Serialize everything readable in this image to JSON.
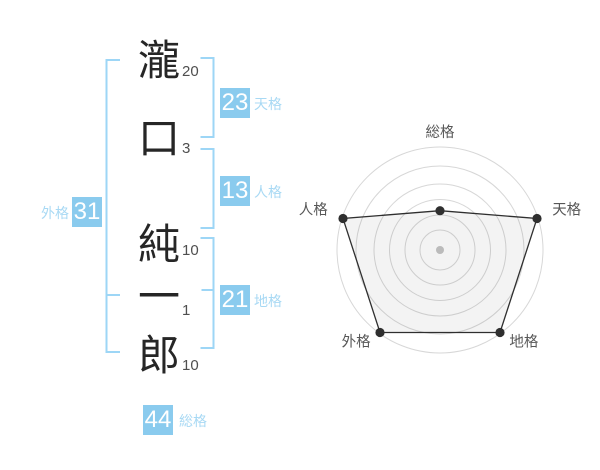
{
  "name_breakdown": {
    "characters": [
      {
        "char": "瀧",
        "strokes": "20"
      },
      {
        "char": "口",
        "strokes": "3"
      },
      {
        "char": "純",
        "strokes": "10"
      },
      {
        "char": "一",
        "strokes": "1"
      },
      {
        "char": "郎",
        "strokes": "10"
      }
    ]
  },
  "kaku": [
    {
      "id": "tenkaku",
      "label": "天格",
      "value": "23"
    },
    {
      "id": "jinkaku",
      "label": "人格",
      "value": "13"
    },
    {
      "id": "chikaku",
      "label": "地格",
      "value": "21"
    },
    {
      "id": "gaikaku",
      "label": "外格",
      "value": "31"
    },
    {
      "id": "soukaku",
      "label": "総格",
      "value": "44"
    }
  ],
  "colors": {
    "box_blue": "#8ACBEE",
    "kaku_label_blue": "#A8D9F4",
    "bracket_blue": "#9DD6F6",
    "name_text": "#262626",
    "stroke_count_text": "#4F4F4F",
    "radar_grid": "#D7D7D7",
    "radar_line": "#2F2F2F",
    "radar_fill": "rgba(80,80,80,0.07)",
    "radar_label": "#575757",
    "radar_center_dot": "#BBBBBB"
  },
  "chart_data": {
    "type": "radar",
    "axes": [
      "総格",
      "天格",
      "地格",
      "外格",
      "人格"
    ],
    "values_percent": [
      38.5,
      100,
      100,
      100,
      100
    ],
    "kaku_values": {
      "総格": 44,
      "天格": 23,
      "地格": 21,
      "外格": 31,
      "人格": 13
    },
    "rings": 6,
    "title": "",
    "legend": "none",
    "axis_order": "clockwise-from-top"
  }
}
